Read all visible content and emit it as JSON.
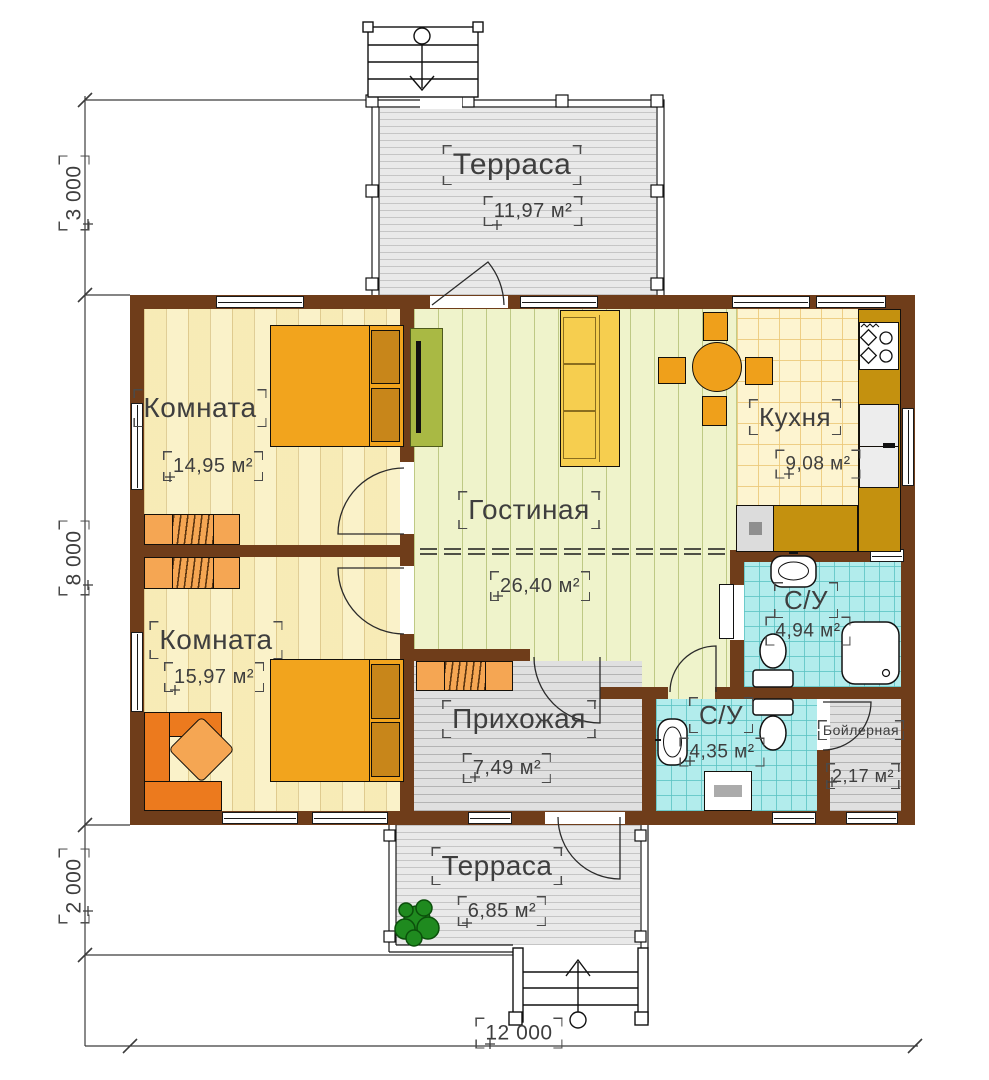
{
  "plan": {
    "title": "house-floor-plan",
    "rooms": [
      {
        "id": "terrace_top",
        "label": "Терраса",
        "area": "11,97 м²"
      },
      {
        "id": "room_top",
        "label": "Комната",
        "area": "14,95 м²"
      },
      {
        "id": "living",
        "label": "Гостиная",
        "area": "26,40 м²"
      },
      {
        "id": "kitchen",
        "label": "Кухня",
        "area": "9,08 м²"
      },
      {
        "id": "bath_top",
        "label": "С/У",
        "area": "4,94 м²"
      },
      {
        "id": "room_bottom",
        "label": "Комната",
        "area": "15,97 м²"
      },
      {
        "id": "hallway",
        "label": "Прихожая",
        "area": "7,49 м²"
      },
      {
        "id": "bath_bottom",
        "label": "С/У",
        "area": "4,35 м²"
      },
      {
        "id": "boiler",
        "label": "Бойлерная",
        "area": "2,17 м²"
      },
      {
        "id": "terrace_bottom",
        "label": "Терраса",
        "area": "6,85 м²"
      }
    ],
    "dimensions": {
      "left_top": "3 000",
      "left_middle": "8 000",
      "left_bottom": "2 000",
      "bottom": "12 000"
    },
    "colors": {
      "wall": "#6F3D1A",
      "bedroom_floor": "#FAF2C9",
      "living_floor": "#EFF3CB",
      "kitchen_floor": "#FDF4D0",
      "bath_floor": "#B2ECEC",
      "utility_floor": "#E0E0E0",
      "deck_floor": "#E9E9E9",
      "furniture_orange": "#F2A41D",
      "pillow_brown": "#C8861A",
      "furniture_light_orange": "#F5A653",
      "desk_orange": "#EC7A1E",
      "sofa_yellow": "#F6CE4F",
      "table_orange": "#EFA01B",
      "cabinet_green": "#A9B944",
      "counter_gold": "#C4910F",
      "tree_green": "#1F8A1F",
      "label_gray": "#3E3E3E"
    }
  }
}
